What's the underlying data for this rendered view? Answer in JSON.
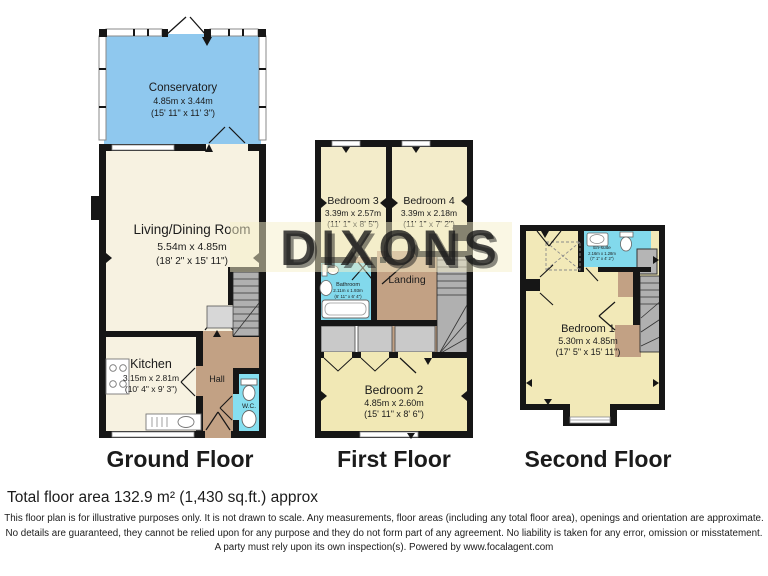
{
  "watermark": {
    "text": "DIXONS"
  },
  "floors": {
    "ground": {
      "label": "Ground Floor",
      "rooms": {
        "conservatory": {
          "name": "Conservatory",
          "metric": "4.85m x 3.44m",
          "imperial": "(15' 11\" x 11' 3\")"
        },
        "living": {
          "name": "Living/Dining Room",
          "metric": "5.54m x 4.85m",
          "imperial": "(18' 2\" x 15' 11\")"
        },
        "kitchen": {
          "name": "Kitchen",
          "metric": "3.15m x 2.81m",
          "imperial": "(10' 4\" x 9' 3\")"
        },
        "hall": {
          "name": "Hall"
        },
        "wc": {
          "name": "W.C."
        }
      }
    },
    "first": {
      "label": "First Floor",
      "rooms": {
        "bedroom3": {
          "name": "Bedroom 3",
          "metric": "3.39m x 2.57m",
          "imperial": "(11' 1\" x 8' 5\")"
        },
        "bedroom4": {
          "name": "Bedroom 4",
          "metric": "3.39m x 2.18m",
          "imperial": "(11' 1\" x 7' 2\")"
        },
        "bathroom": {
          "name": "Bathroom",
          "metric": "2.11m x 1.93m",
          "imperial": "(6' 11\" x 6' 4\")"
        },
        "landing": {
          "name": "Landing"
        },
        "bedroom2": {
          "name": "Bedroom 2",
          "metric": "4.85m x 2.60m",
          "imperial": "(15' 11\" x 8' 6\")"
        }
      }
    },
    "second": {
      "label": "Second Floor",
      "rooms": {
        "bedroom1": {
          "name": "Bedroom 1",
          "metric": "5.30m x 4.85m",
          "imperial": "(17' 5\" x 15' 11\")"
        },
        "ensuite": {
          "name": "En-suite",
          "metric": "2.16m x 1.28m",
          "imperial": "(7' 1\" x 4' 2\")"
        }
      }
    }
  },
  "footer": {
    "total_area": "Total floor area 132.9 m² (1,430 sq.ft.) approx",
    "disclaimer": "This floor plan is for illustrative purposes only. It is not drawn to scale. Any measurements, floor areas (including any total floor area), openings and orientation are approximate. No details are guaranteed, they cannot be relied upon for any purpose and they do not form part of any agreement. No liability is taken for any error, omission or misstatement. A party must rely upon its own inspection(s). Powered by www.focalagent.com"
  },
  "colors": {
    "wall": "#161616",
    "conservatory_blue": "#8fc8ee",
    "bathroom_blue": "#82d9ec",
    "hall_tan": "#c2a184",
    "ground_cream": "#f7f2e1",
    "bedroom_yellow": "#f2e9bc",
    "stairs_gray": "#b0b0b0",
    "watermark_blue": "#a9cbe7",
    "watermark_gold": "#c79f3e"
  }
}
